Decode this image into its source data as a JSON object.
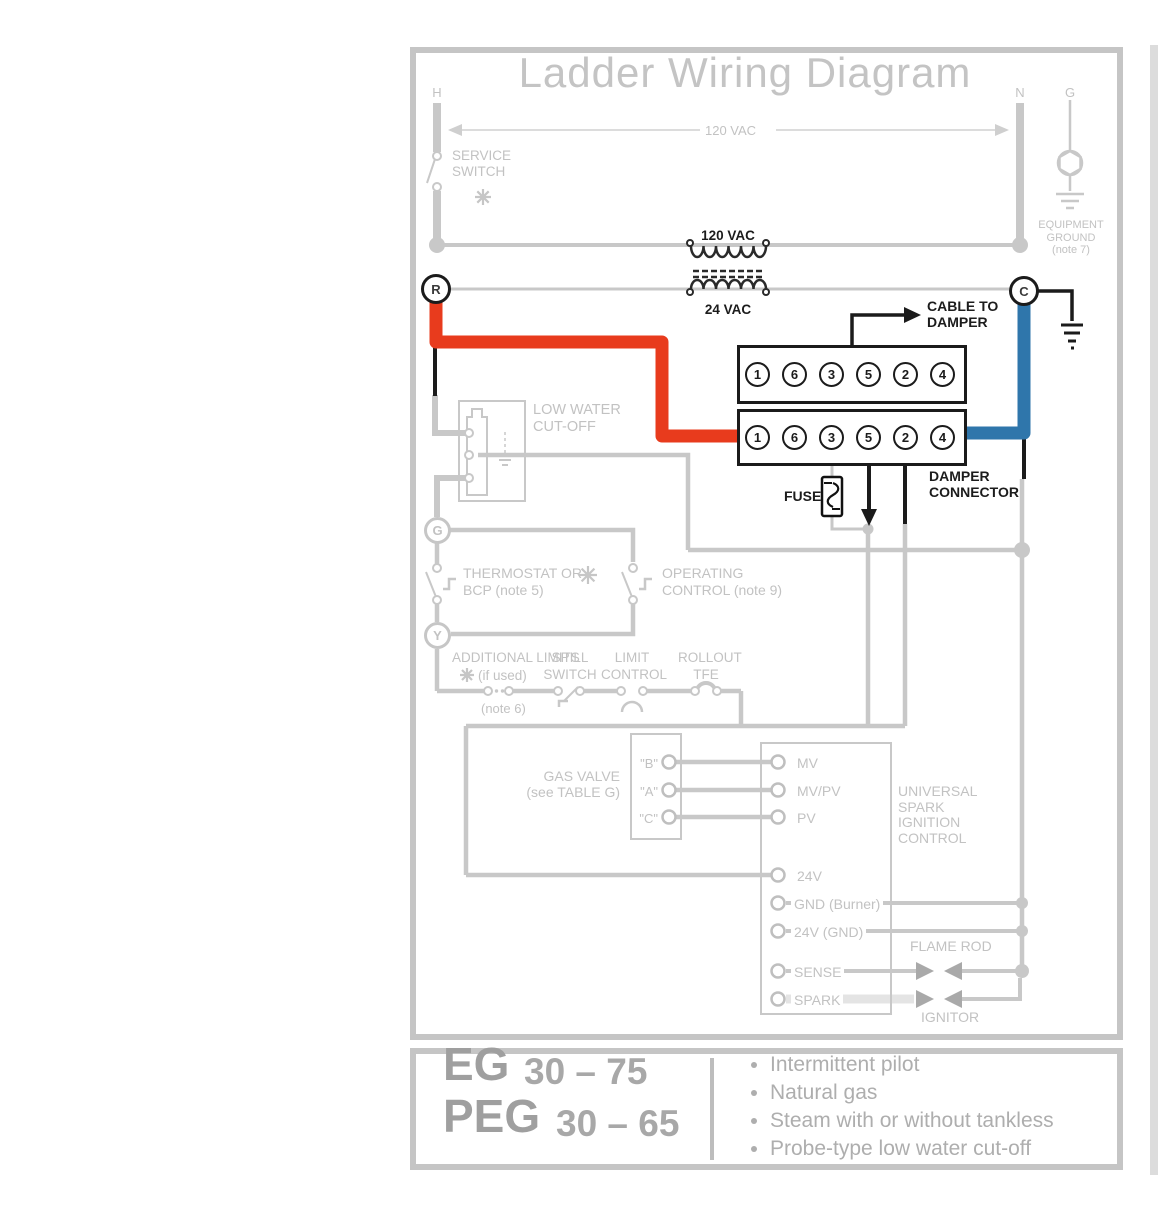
{
  "colors": {
    "red_wire": "#e83b1d",
    "blue_wire": "#2f76ab",
    "faded_gray": "#c8c8c8",
    "dark": "#1b1b1b"
  },
  "title": "Ladder Wiring Diagram",
  "rails": {
    "h": "H",
    "n": "N",
    "g": "G",
    "line_voltage": "120 VAC"
  },
  "service_switch": [
    "SERVICE",
    "SWITCH"
  ],
  "equipment_ground": [
    "EQUIPMENT",
    "GROUND",
    "(note 7)"
  ],
  "transformer": {
    "primary": "120 VAC",
    "secondary": "24 VAC"
  },
  "terminals": {
    "r": "R",
    "c": "C",
    "g": "G",
    "y": "Y"
  },
  "cable_to_damper": [
    "CABLE TO",
    "DAMPER"
  ],
  "connector": {
    "pins": [
      "1",
      "6",
      "3",
      "5",
      "2",
      "4"
    ],
    "label": [
      "DAMPER",
      "CONNECTOR"
    ],
    "fuse": "FUSE"
  },
  "low_water_cutoff": [
    "LOW WATER",
    "CUT-OFF"
  ],
  "thermostat": [
    "THERMOSTAT OR",
    "BCP (note 5)"
  ],
  "operating_control": [
    "OPERATING",
    "CONTROL (note 9)"
  ],
  "additional_limits": [
    "ADDITIONAL LIMITS",
    "(if used)",
    "(note 6)"
  ],
  "spill_switch": [
    "SPILL",
    "SWITCH"
  ],
  "limit_control": [
    "LIMIT",
    "CONTROL"
  ],
  "rollout": [
    "ROLLOUT",
    "TFE"
  ],
  "gas_valve": {
    "label": [
      "GAS VALVE",
      "(see TABLE G)"
    ],
    "terms": [
      "\"B\"",
      "\"A\"",
      "\"C\""
    ]
  },
  "ignition": {
    "terms": [
      "MV",
      "MV/PV",
      "PV",
      "24V",
      "GND (Burner)",
      "24V (GND)",
      "SENSE",
      "SPARK"
    ],
    "label": [
      "UNIVERSAL",
      "SPARK",
      "IGNITION",
      "CONTROL"
    ],
    "flame_rod": "FLAME ROD",
    "ignitor": "IGNITOR"
  },
  "footer": {
    "models": [
      {
        "code": "EG",
        "range": "30 – 75"
      },
      {
        "code": "PEG",
        "range": "30 – 65"
      }
    ],
    "bullets": [
      "Intermittent pilot",
      "Natural gas",
      "Steam with or without tankless",
      "Probe-type low water cut-off"
    ]
  }
}
